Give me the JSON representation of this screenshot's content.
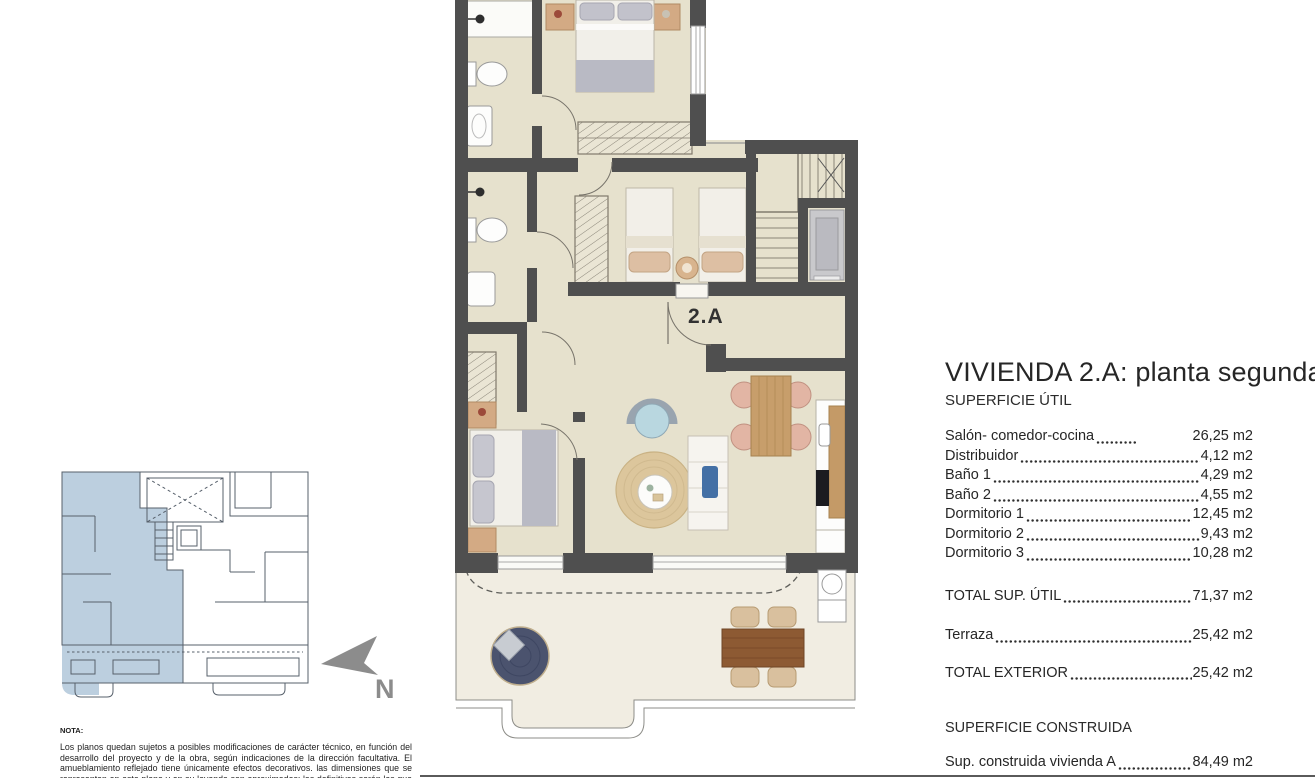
{
  "plan": {
    "unit_label": "2.A"
  },
  "compass": {
    "label": "N"
  },
  "panel": {
    "title": "VIVIENDA 2.A: planta segunda",
    "util_heading": "SUPERFICIE ÚTIL",
    "util_rows": [
      {
        "label": "Salón- comedor-cocina",
        "value": "26,25 m2"
      },
      {
        "label": "Distribuidor",
        "value": "4,12 m2"
      },
      {
        "label": "Baño 1",
        "value": "4,29 m2"
      },
      {
        "label": "Baño 2",
        "value": "4,55 m2"
      },
      {
        "label": "Dormitorio 1",
        "value": "12,45 m2"
      },
      {
        "label": "Dormitorio 2",
        "value": "9,43 m2"
      },
      {
        "label": "Dormitorio 3",
        "value": "10,28 m2"
      }
    ],
    "total_util": {
      "label": "TOTAL SUP. ÚTIL",
      "value": "71,37 m2"
    },
    "terraza": {
      "label": "Terraza",
      "value": "25,42 m2"
    },
    "total_exterior": {
      "label": "TOTAL EXTERIOR",
      "value": "25,42 m2"
    },
    "construida_heading": "SUPERFICIE CONSTRUIDA",
    "construida_row": {
      "label": "Sup. construida vivienda A",
      "value": "84,49 m2"
    }
  },
  "note": {
    "heading": "NOTA:",
    "body": "Los planos quedan sujetos a posibles modificaciones de carácter técnico, en función del desarrollo del proyecto y de la obra, según indicaciones de la dirección facultativa. El amueblamiento reflejado tiene únicamente efectos decorativos. las dimensiones que se representan en este plano y en su leyenda son aproximadas; las definitivas serán las que resulten de la ejecución de la obra. Se hace"
  },
  "colors": {
    "wall": "#4f4f4f",
    "floor": "#e6e1cd",
    "terrace_floor": "#f1ede2",
    "keyplan_highlight": "#bccfdf",
    "daybed_navy": "#4b536e",
    "wood_dark": "#8d5a33",
    "wood_light": "#c79e6b",
    "armchair_blue": "#b9d7e0"
  }
}
